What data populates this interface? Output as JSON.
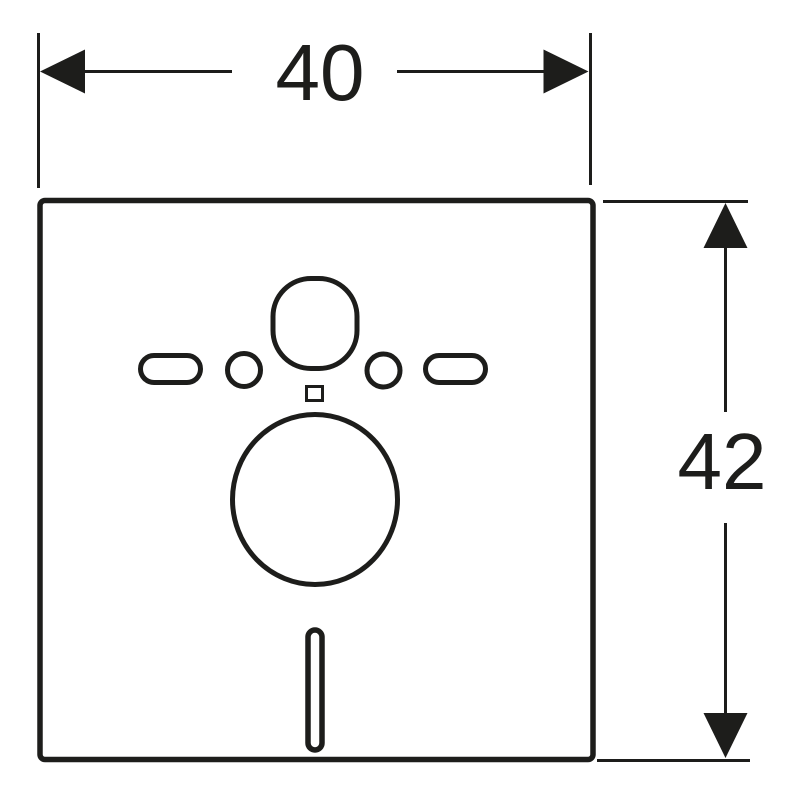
{
  "drawing": {
    "background_color": "#ffffff",
    "line_color": "#1d1d1b",
    "dimensions": {
      "width": {
        "label": "40",
        "position": "top",
        "orientation": "horizontal"
      },
      "height": {
        "label": "42",
        "position": "right",
        "orientation": "vertical"
      }
    }
  }
}
